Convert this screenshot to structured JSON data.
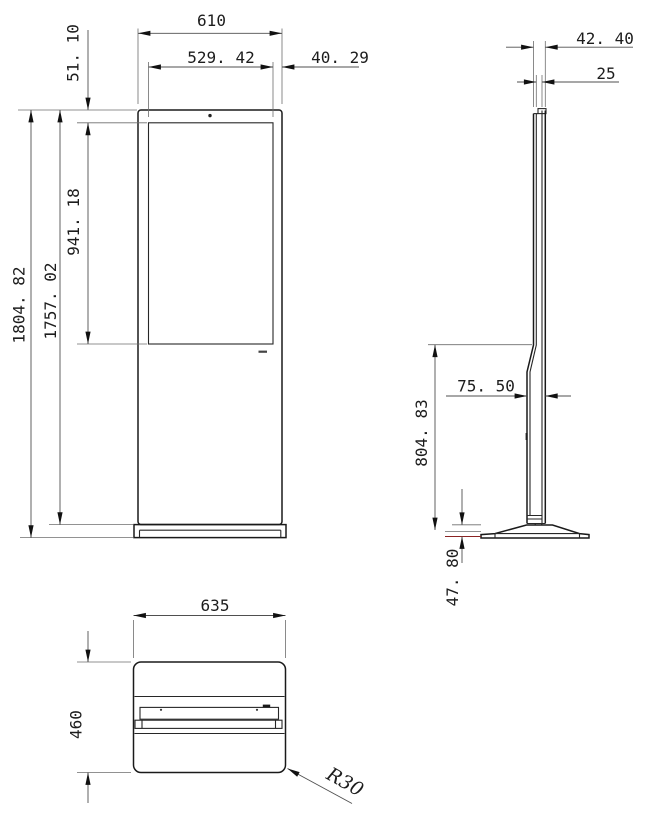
{
  "drawing": {
    "type": "engineering-dimension-drawing",
    "colors": {
      "line": "#1a1a1a",
      "dimension": "#4f4f4f",
      "floor_line_red": "#8b2323",
      "background": "#ffffff"
    },
    "front": {
      "overall_width": "610",
      "screen_width": "529. 42",
      "screen_right_offset": "40. 29",
      "screen_top_offset": "51. 10",
      "screen_height": "941. 18",
      "overall_height": "1804. 82",
      "cabinet_height": "1757. 02"
    },
    "side": {
      "top_depth": "42. 40",
      "screen_depth": "25",
      "lower_depth": "75. 50",
      "lower_height": "804. 83",
      "base_height": "47. 80"
    },
    "bottom": {
      "base_width": "635",
      "base_depth": "460",
      "corner_radius": "R30"
    }
  }
}
